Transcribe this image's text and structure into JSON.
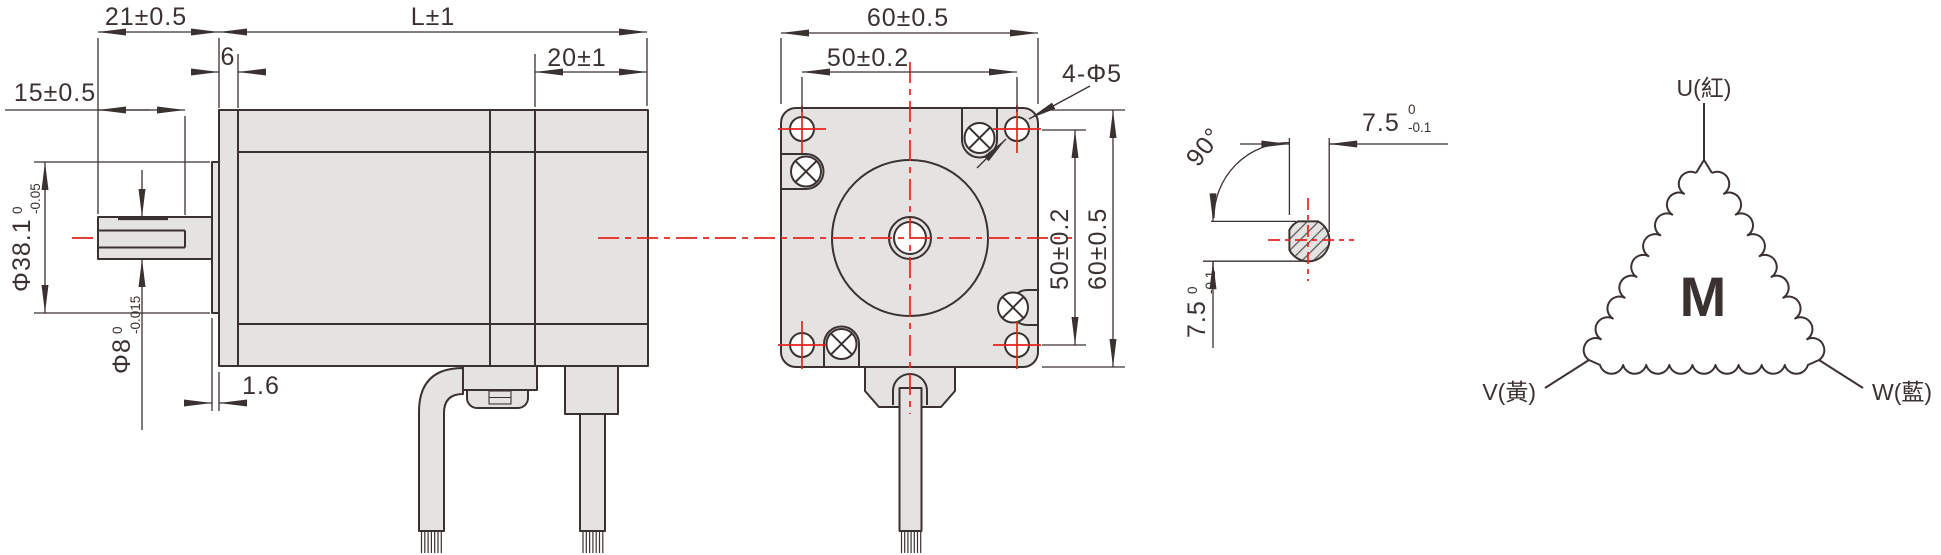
{
  "drawing_type": "stepper-motor-dimensional-drawing",
  "colors": {
    "line": "#3a3230",
    "body_fill": "#e4e3e1",
    "centerline_red": "#e8231f",
    "background": "#ffffff"
  },
  "side": {
    "shaft_ext": "21±0.5",
    "flat_len": "15±0.5",
    "front_step": "6",
    "body_len": "L±1",
    "rear_len": "20±1",
    "boss_thk": "1.6",
    "boss_dia": "Φ38.1",
    "boss_tol_u": "0",
    "boss_tol_l": "-0.05",
    "shaft_dia": "Φ8",
    "shaft_tol_u": "0",
    "shaft_tol_l": "-0.015"
  },
  "front": {
    "width_top": "60±0.5",
    "pitch_top": "50±0.2",
    "holes_label": "4-Φ5",
    "pitch_side": "50±0.2",
    "height_side": "60±0.5"
  },
  "section": {
    "angle": "90°",
    "width_val": "7.5",
    "width_tol_u": "0",
    "width_tol_l": "-0.1",
    "height_val": "7.5",
    "height_tol_u": "0",
    "height_tol_l": "-0.1"
  },
  "winding": {
    "symbol": "M",
    "terminal_u": "U(紅)",
    "terminal_v": "V(黃)",
    "terminal_w": "W(藍)"
  }
}
